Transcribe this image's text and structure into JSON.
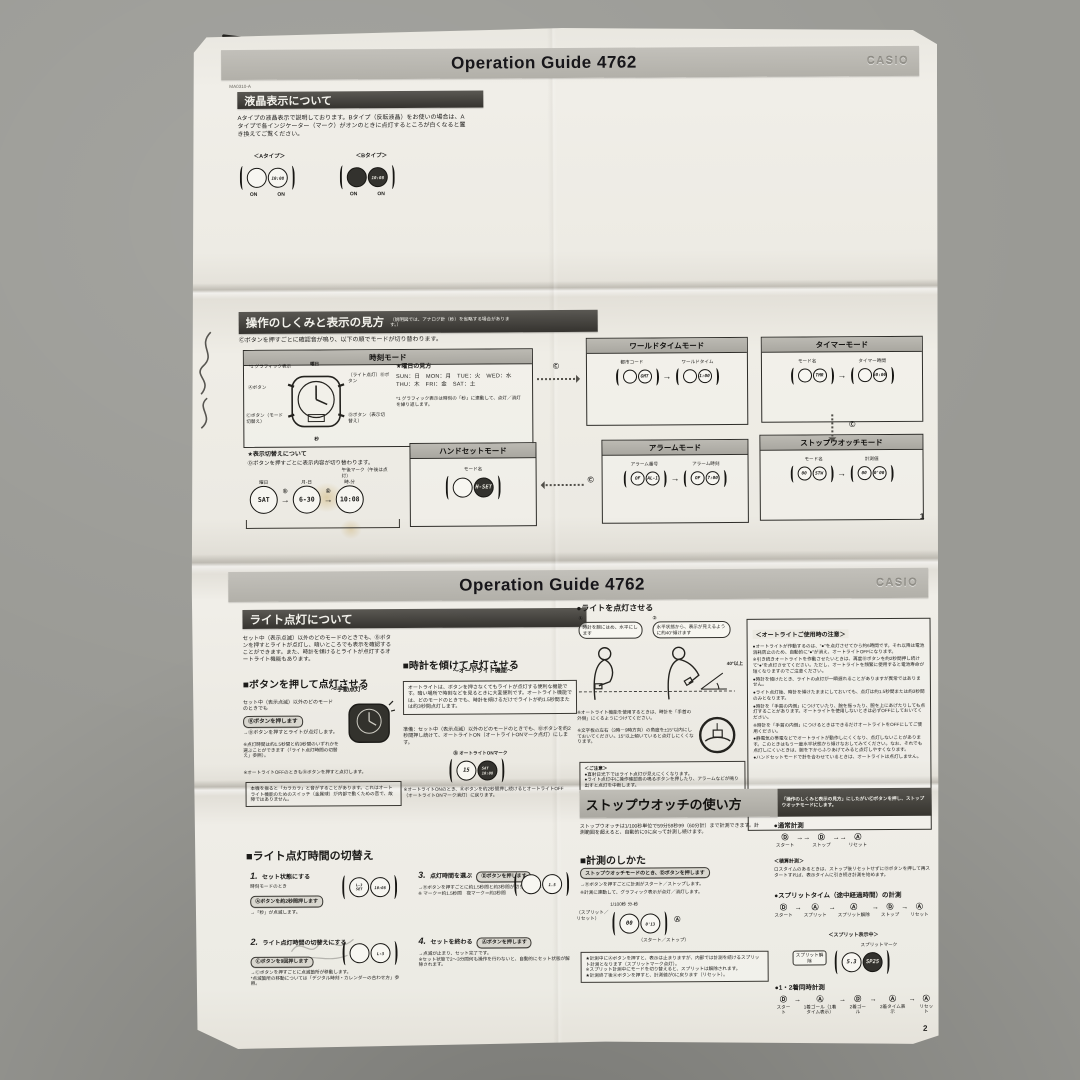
{
  "photo": {
    "surface_color": "#9a9a95",
    "paper_color": "#eeece5"
  },
  "p1": {
    "code": "MA0310-A",
    "header": {
      "title": "Operation Guide 4762",
      "brand": "CASIO"
    },
    "lcd": {
      "title": "液晶表示について",
      "body": "Aタイプの液晶表示で説明しております。Bタイプ（反転液晶）をお使いの場合は、Aタイプで各インジケーター（マーク）がオンのときに点灯するところが白くなると置き換えてご覧ください。",
      "type_a": "＜Aタイプ＞",
      "type_b": "＜Bタイプ＞",
      "on": "ON"
    },
    "op": {
      "title": "操作のしくみと表示の見方",
      "note": "（説明図では、アナログ針（秒）を省略する場合があります。）",
      "lead": "Ⓒボタンを押すごとに確認音が鳴り、以下の順でモードが切り替わります。",
      "c_btn": "Ⓒ",
      "time": {
        "title": "時刻モード",
        "graphic_label": "*1 グラフィック表示",
        "day_label": "曜日",
        "btn_a": "Ⓐボタン",
        "btn_b": "（ライト点灯）Ⓑボタン",
        "btn_c": "Ⓒボタン（モード切替え）",
        "btn_d": "Ⓓボタン（表示切替え）",
        "sec_label": "秒",
        "day_guide_title": "★曜日の見方",
        "day_guide1": "SUN：日　MON：月　TUE：火　WED：水",
        "day_guide2": "THU：木　FRI：金　SAT：土",
        "footnote": "*1 グラフィック表示は時刻の「秒」に連動して、点灯／消灯を繰り返します。",
        "switch_title": "★表示切替えについて",
        "switch_body": "Ⓓボタンを押すごとに表示内容が切り替わります。",
        "pm_label": "午後マーク（午後は点灯）",
        "d_btn": "Ⓓ",
        "flow": [
          {
            "value": "SAT",
            "label": "曜日"
          },
          {
            "value": "6-30",
            "label": "月-日"
          },
          {
            "value": "10:08",
            "label": "時-分"
          }
        ]
      },
      "handset": {
        "title": "ハンドセットモード",
        "label": "モード名",
        "display": "H-SET"
      },
      "world": {
        "title": "ワールドタイムモード",
        "label1": "都市コード",
        "label2": "ワールドタイム",
        "display1": "GMT",
        "display2": "1:00"
      },
      "timer": {
        "title": "タイマーモード",
        "label1": "モード名",
        "label2": "タイマー時間",
        "display1": "TMR",
        "display2": "60:00"
      },
      "alarm": {
        "title": "アラームモード",
        "label1": "アラーム番号",
        "label2": "アラーム時刻",
        "display1": "AL-1",
        "display2": "7:00"
      },
      "sw": {
        "title": "ストップウオッチモード",
        "label1": "モード名",
        "label2": "計測値",
        "display1": "STW",
        "display2": "0'00"
      }
    },
    "page_no": "1"
  },
  "p2": {
    "header": {
      "title": "Operation Guide 4762",
      "brand": "CASIO"
    },
    "light": {
      "title": "ライト点灯について",
      "intro": "セット中（表示点滅）以外のどのモードのときでも、Ⓑボタンを押すとライトが点灯し、暗いところでも表示を確認することができます。また、時計を傾けるとライトが点灯するオートライト機能もあります。",
      "manual_title": "■ボタンを押して点灯させる",
      "manual_sub": "～手動点灯～",
      "manual_cond": "セット中（表示点滅）以外のどのモードのときでも",
      "manual_btn": "Ⓑボタンを押します",
      "manual_result": "→Ⓑボタンを押すとライトが点灯します。",
      "manual_note1": "※点灯時間は約1.5秒間と約3秒間のいずれかを選ぶことができます（「ライト点灯時間の切替え」参照）。",
      "manual_note2": "※オートライトOFFのときもⒷボタンを押すと点灯します。",
      "rattle": "本機を振ると「カラカラ」と音がすることがあります。これはオートライト機能のためのスイッチ（金属球）が内部で動くための音で、故障ではありません。",
      "auto_title": "■時計を傾けて点灯させる",
      "auto_sub": "～オートライト機能～",
      "auto_desc": "オートライトは、ボタンを押さなくてもライトが点灯する便利な機能です。暗い場所で時刻などを見るときに大変便利です。オートライト機能では、どのモードのときでも、時計を傾けるだけでライトが約1.5秒間または約3秒間点灯します。",
      "auto_prep": "準備：セット中（表示点滅）以外のどのモードのときでも、Ⓑボタンを約2秒間押し続けて、オートライトON（オートライトONマーク点灯）にします。",
      "auto_mark": "Ⓑ オートライトONマーク",
      "auto_off": "※オートライトONのとき、Ⓑボタンを約2秒間押し続けるとオートライトOFF（オートライトONマーク消灯）に戻ります。",
      "tilt_title": "●ライトを点灯させる",
      "tilt_step1": "①",
      "tilt_step2": "②",
      "bubble1": "時計を腕にはめ、水平にします",
      "bubble2": "水平状態から、表示が見えるように約40°傾けます",
      "angle": "40°以上",
      "tilt_note1": "※オートライト機能を使用するときは、時計を「手首の外側」にくるようにつけてください。",
      "tilt_note2": "※文字板の左右（3時－9時方向）の角度を±15°以内にしておいてください。15°以上傾いていると点灯しにくくなります。",
      "caution_title": "＜ご注意＞",
      "caution1": "●直射日光下ではライト点灯が見えにくくなります。",
      "caution2": "●ライト点灯中に操作確認音の鳴るボタンを押したり、アラームなどが鳴り出すと点灯を中断します。",
      "warn_title": "＜オートライトご使用時の注意＞",
      "warn_items": [
        "●オートライトが作動するのは、\"●\"を点灯させてから約6時間です。それ以降は電池消耗防止のため、自動的に\"●\"が消え、オートライトOFFになります。",
        "※引き続きオートライトを作動させたいときは、再度Ⓑボタンを約2秒間押し続けて\"●\"を点灯させてください。ただし、オートライトを頻繁に使用すると電池寿命が短くなりますのでご注意ください。",
        "●時計を傾けたとき、ライトの点灯が一瞬遅れることがありますが異常ではありません。",
        "●ライト点灯後、時計を傾けたままにしておいても、点灯は約1.5秒間または約3秒間のみとなります。",
        "●時計を「手首の内側」につけていたり、腕を振ったり、腕を上にあげたりしても点灯することがあります。オートライトを使用しないときは必ずOFFにしておいてください。",
        "※時計を「手首の内側」につけるときはできるだけオートライトをOFFにしてご使用ください。",
        "●静電気の帯電などでオートライトが動作しにくくなり、点灯しないことがあります。このときはもう一度水平状態から傾けなおしてみてください。なお、それでも点灯しにくいときは、腕を下からふりあげてみると点灯しやすくなります。",
        "●ハンドセットモードで針を合わせているときは、オートライトは点灯しません。"
      ]
    },
    "duration": {
      "title": "■ライト点灯時間の切替え",
      "steps": [
        {
          "num": "1.",
          "title": "セット状態にする",
          "pre": "時刻モードのとき",
          "btn": "Ⓐボタンを約2秒間押します",
          "lines": "→「秒」が点滅します。"
        },
        {
          "num": "2.",
          "title": "ライト点灯時間の切替えにする",
          "pre": "",
          "btn": "Ⓒボタンを9回押します",
          "lines": "→Ⓒボタンを押すごとに点滅箇所が移動します。\n*点滅箇所の移動については「デジタル時刻・カレンダーの合わせ方」参照。"
        },
        {
          "num": "3.",
          "title": "点灯時間を選ぶ",
          "pre": "",
          "btn": "Ⓓボタンを押します",
          "lines": "→Ⓓボタンを押すごとに約1.5秒間と約3秒間が切り替わります。\n※ マーク＝約1.5秒間　夜マーク＝約3秒間"
        },
        {
          "num": "4.",
          "title": "セットを終わる",
          "pre": "",
          "btn": "Ⓐボタンを押します",
          "lines": "→点滅が止まり、セット完了です。\n※セット状態で2～3分間何も操作を行わないと、自動的にセット状態が解除されます。"
        }
      ]
    },
    "sw": {
      "title": "ストップウオッチの使い方",
      "title_note": "「操作のしくみと表示の見方」にしたがいⒸボタンを押し、ストップウオッチモードにします。",
      "intro": "ストップウオッチは1/100秒単位で59分59秒99（60分計）まで計測できます。計測範囲を超えると、自動的に0に戻って計測し続けます。",
      "how_title": "■計測のしかた",
      "how_btn": "ストップウオッチモードのとき、Ⓓボタンを押します",
      "how_result": "→Ⓓボタンを押すごとに計測がスタート／ストップします。",
      "how_note": "※計測に連動して、グラフィック表示が点灯／消灯します。",
      "lbl_split_reset": "（スプリット／リセット）",
      "lbl_unit": "1/100秒 分-秒",
      "lbl_a": "Ⓐ",
      "lbl_start_stop": "（スタート／ストップ）",
      "star_note": "★計測中にⒶボタンを押すと、表示は止まりますが、内部では計測を続けるスプリット計測となります（スプリットマーク点灯）。\n※スプリット計測中にモードを切り替えると、スプリットは解除されます。\n★計測終了後Ⓐボタンを押すと、計測値が0に戻ります（リセット）。",
      "normal_title": "●通常計測",
      "normal_flow": [
        {
          "btn": "Ⓓ",
          "label": "スタート"
        },
        {
          "btn": "Ⓓ",
          "label": "ストップ"
        },
        {
          "btn": "Ⓐ",
          "label": "リセット"
        }
      ],
      "accum_title": "＜積算計測＞",
      "accum_body": "ロスタイムのあるときは、ストップ後リセットせずにⒹボタンを押して再スタートすれば、表示タイムに引き続き計測を始めます。",
      "split_title": "●スプリットタイム（途中経過時間）の計測",
      "split_flow": [
        {
          "btn": "Ⓓ",
          "label": "スタート"
        },
        {
          "btn": "Ⓐ",
          "label": "スプリット"
        },
        {
          "btn": "Ⓐ",
          "label": "スプリット解除"
        },
        {
          "btn": "Ⓓ",
          "label": "ストップ"
        },
        {
          "btn": "Ⓐ",
          "label": "リセット"
        }
      ],
      "split_disp_title": "＜スプリット表示中＞",
      "split_mark": "スプリットマーク",
      "split_release": "スプリット解除",
      "split_display1": "5.3",
      "split_display2": "SP25",
      "dual_title": "●1・2着同時計測",
      "dual_flow": [
        {
          "btn": "Ⓓ",
          "label": "スタート"
        },
        {
          "btn": "Ⓐ",
          "label": "1着ゴール（1着タイム表示）"
        },
        {
          "btn": "Ⓓ",
          "label": "2着ゴール"
        },
        {
          "btn": "Ⓐ",
          "label": "2着タイム表示"
        },
        {
          "btn": "Ⓐ",
          "label": "リセット"
        }
      ]
    },
    "page_no": "2"
  }
}
